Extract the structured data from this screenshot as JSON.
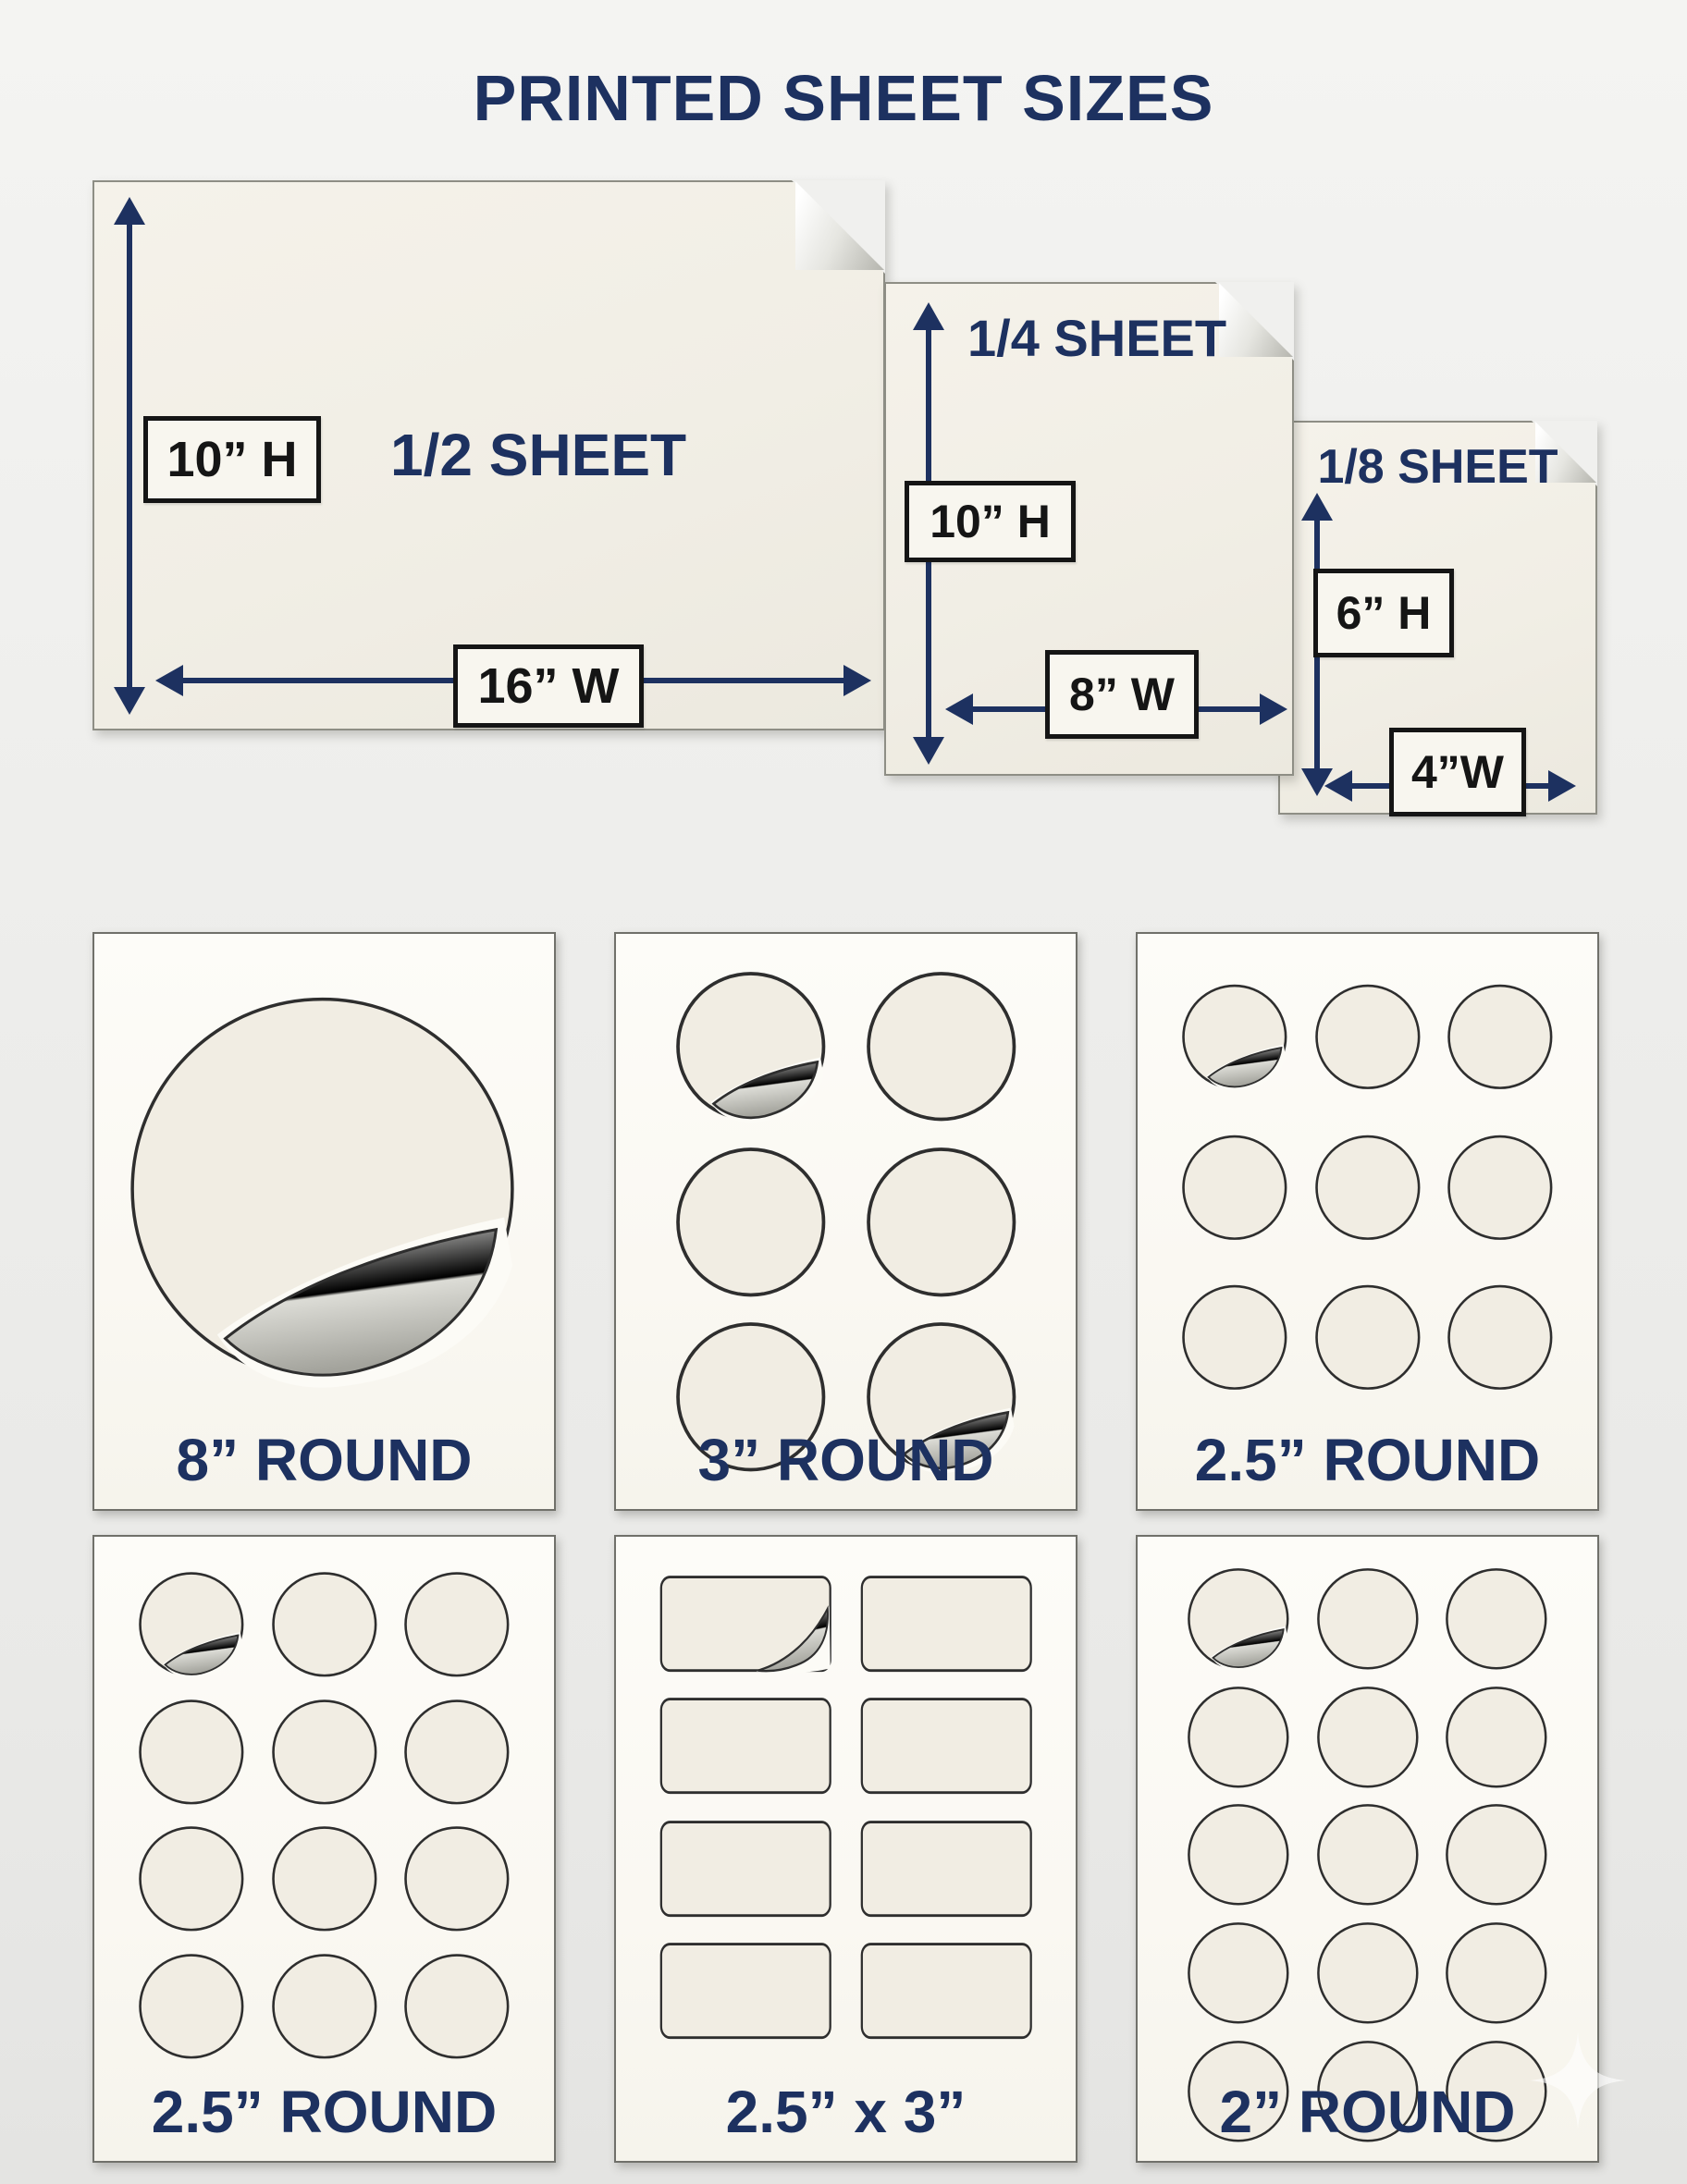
{
  "title": "PRINTED SHEET SIZES",
  "colors": {
    "navy": "#1d3160",
    "sheet_fill": "#f1eee5",
    "card_fill": "#fcfbf6",
    "sticker_fill": "#f1ede3",
    "label_ink": "#151515"
  },
  "sheets": [
    {
      "label": "1/2 SHEET",
      "height_label": "10” H",
      "width_label": "16” W"
    },
    {
      "label": "1/4 SHEET",
      "height_label": "10” H",
      "width_label": "8” W"
    },
    {
      "label": "1/8 SHEET",
      "height_label": "6” H",
      "width_label": "4”W"
    }
  ],
  "cards": [
    {
      "label": "8” ROUND",
      "shape": "circle",
      "cols": 1,
      "rows": 1,
      "peels": [
        0
      ],
      "big": true
    },
    {
      "label": "3” ROUND",
      "shape": "circle",
      "cols": 2,
      "rows": 3,
      "peels": [
        0,
        5
      ],
      "big": false
    },
    {
      "label": "2.5” ROUND",
      "shape": "circle",
      "cols": 3,
      "rows": 3,
      "peels": [
        0
      ],
      "big": false
    },
    {
      "label": "2.5” ROUND",
      "shape": "circle",
      "cols": 3,
      "rows": 4,
      "peels": [
        0
      ],
      "big": false
    },
    {
      "label": "2.5” x 3”",
      "shape": "rect",
      "cols": 2,
      "rows": 4,
      "peels": [
        0
      ],
      "big": false
    },
    {
      "label": "2” ROUND",
      "shape": "circle",
      "cols": 3,
      "rows": 5,
      "peels": [
        0
      ],
      "big": false
    }
  ],
  "watermark": {
    "icon": "sparkle-star"
  }
}
